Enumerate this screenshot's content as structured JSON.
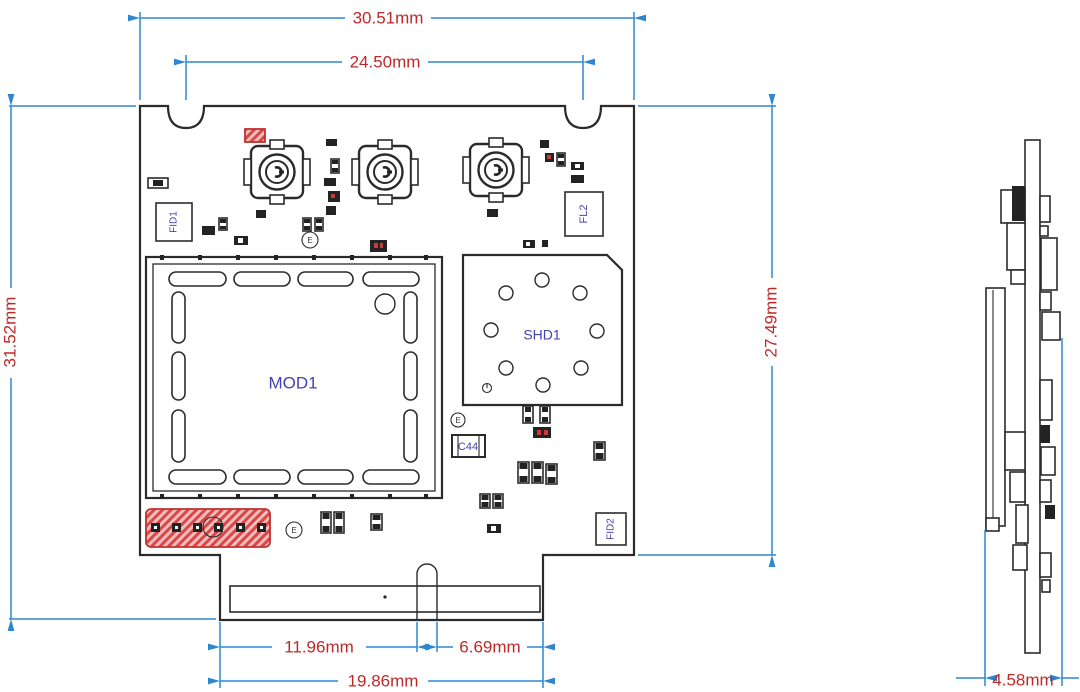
{
  "drawing": {
    "dimensions": {
      "top_width": "30.51mm",
      "inner_width": "24.50mm",
      "left_height": "31.52mm",
      "right_height": "27.49mm",
      "tab_left_offset": "11.96mm",
      "tab_right_offset": "6.69mm",
      "tab_width": "19.86mm",
      "side_thickness": "4.58mm"
    },
    "labels": {
      "module": "MOD1",
      "shield": "SHD1",
      "filter": "FL2",
      "fiducial1": "FID1",
      "fiducial2": "FID2",
      "capacitor": "C44",
      "marker_glyph": "E"
    },
    "colors": {
      "dimension_line": "#2e86d0",
      "dimension_text": "#c02828",
      "outline": "#2b2b2b",
      "label_text": "#4343ae",
      "highlight": "#cc3b3b"
    }
  }
}
